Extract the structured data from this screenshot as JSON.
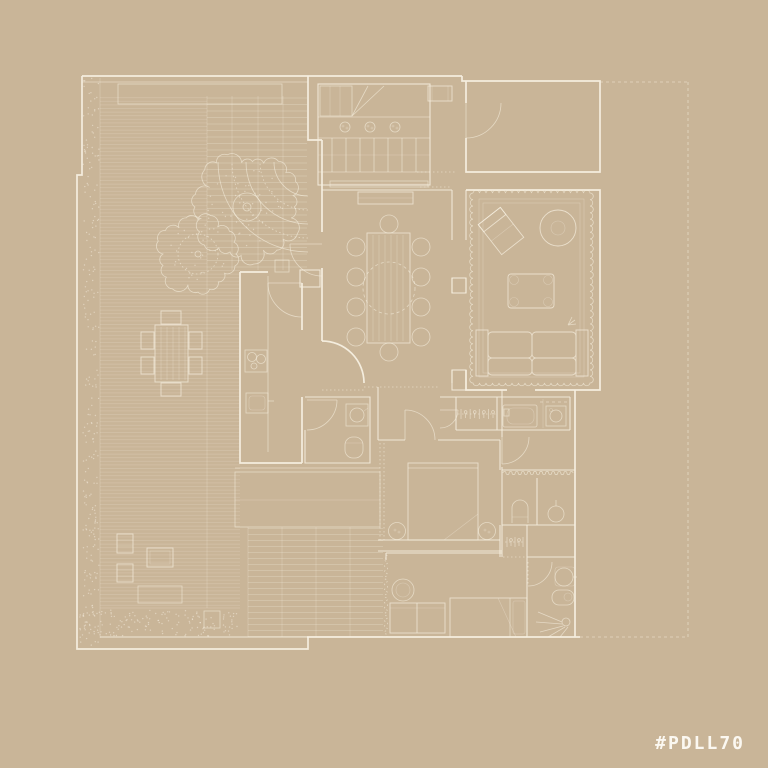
{
  "watermark": {
    "text": "#PDLL70"
  },
  "palette": {
    "background": "#C9B598",
    "line": "#F7F0E1",
    "watermark": "#FBF8F1"
  },
  "plan": {
    "type": "architectural-floor-plan",
    "drawing_style": "white-line blueprint on tan background",
    "rooms": [
      "staircase-hall",
      "entry",
      "garage-room",
      "dining-room",
      "kitchen",
      "living-room",
      "powder-room",
      "corridor",
      "laundry-bathroom",
      "bedroom-1",
      "shower-rooms",
      "dressing",
      "bathroom-shower",
      "bedroom-2",
      "terrace-deck",
      "courtyard",
      "garden-border"
    ],
    "outdoor_elements": [
      "tree-large",
      "tree-small",
      "curved-path",
      "outdoor-dining-set",
      "lounge-chairs",
      "doormat",
      "planting-strip"
    ],
    "furniture": [
      "dining-table-10-seats",
      "sideboard",
      "pendant-light-circle",
      "kitchen-counter",
      "cooktop",
      "kitchen-sink",
      "rug-scalloped",
      "armchair",
      "round-side-table",
      "coffee-table",
      "sofa",
      "bathtub",
      "washing-machine",
      "wardrobe-hangers",
      "double-bed",
      "bedside-lamps",
      "toilet",
      "washbasin",
      "shower-spray",
      "bed-2",
      "loveseat",
      "round-chair"
    ],
    "boundary": "dashed-property-line-right"
  }
}
